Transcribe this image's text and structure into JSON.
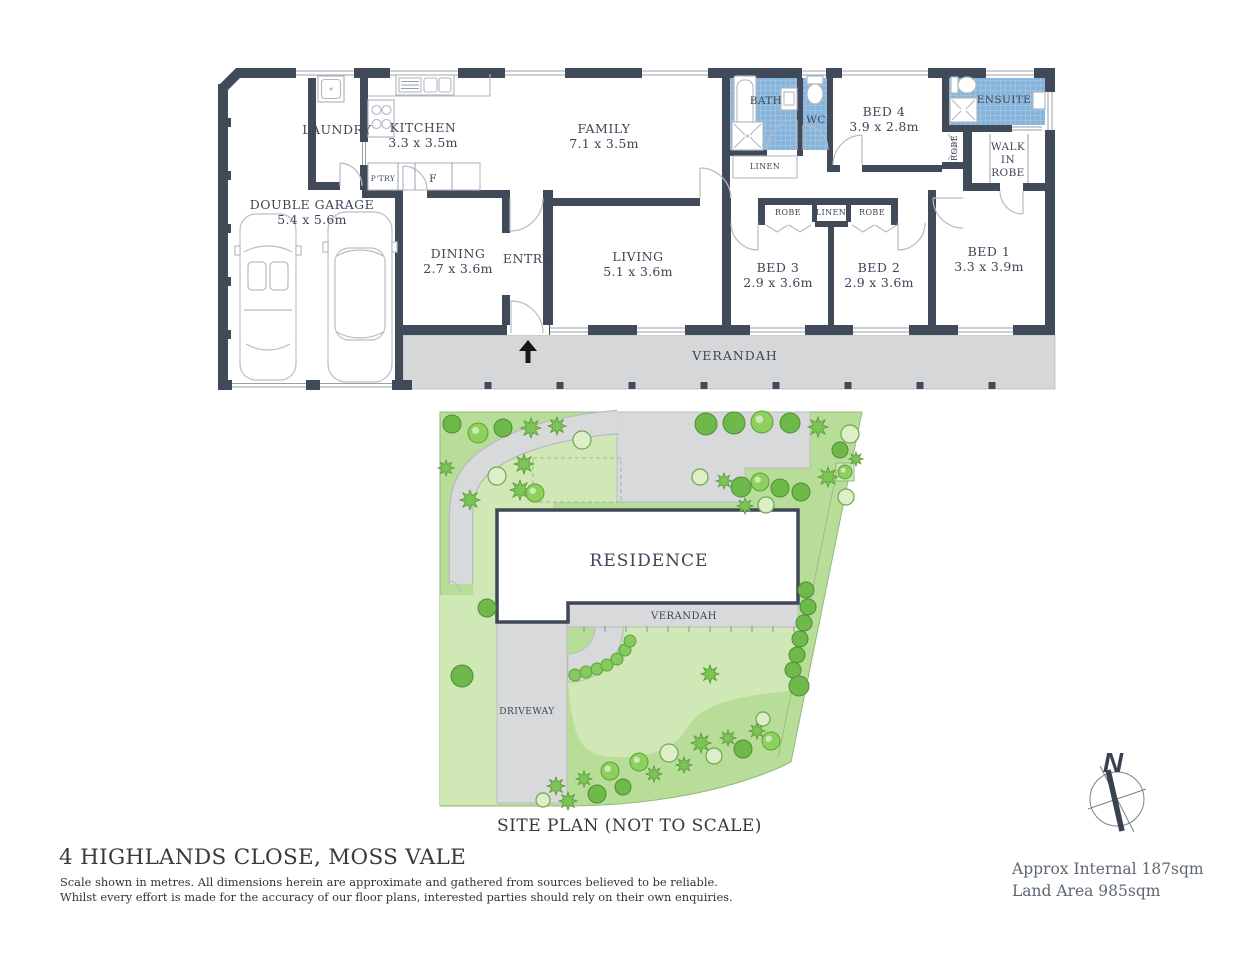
{
  "floorplan": {
    "rooms": [
      {
        "name": "LAUNDRY",
        "dims": ""
      },
      {
        "name": "KITCHEN",
        "dims": "3.3 x 3.5m"
      },
      {
        "name": "FAMILY",
        "dims": "7.1 x 3.5m"
      },
      {
        "name": "BATH",
        "dims": ""
      },
      {
        "name": "WC",
        "dims": ""
      },
      {
        "name": "BED 4",
        "dims": "3.9 x 2.8m"
      },
      {
        "name": "ENSUITE",
        "dims": ""
      },
      {
        "name": "DOUBLE GARAGE",
        "dims": "5.4 x 5.6m"
      },
      {
        "name": "DINING",
        "dims": "2.7 x 3.6m"
      },
      {
        "name": "ENTRY",
        "dims": ""
      },
      {
        "name": "LIVING",
        "dims": "5.1 x 3.6m"
      },
      {
        "name": "BED 3",
        "dims": "2.9 x 3.6m"
      },
      {
        "name": "BED 2",
        "dims": "2.9 x 3.6m"
      },
      {
        "name": "BED 1",
        "dims": "3.3 x 3.9m"
      },
      {
        "name": "VERANDAH",
        "dims": ""
      }
    ],
    "storage": {
      "robe": "ROBE",
      "linen": "LINEN",
      "pantry": "P'TRY",
      "fridge": "F",
      "walk_in_robe": [
        "WALK",
        "IN",
        "ROBE"
      ]
    }
  },
  "site_plan": {
    "residence_label": "RESIDENCE",
    "verandah_label": "VERANDAH",
    "driveway_label": "DRIVEWAY",
    "caption": "SITE PLAN (NOT TO SCALE)"
  },
  "compass": {
    "north_label": "N"
  },
  "footer": {
    "address": "4 HIGHLANDS CLOSE, MOSS VALE",
    "disclaimer_line1": "Scale shown in metres. All dimensions herein are approximate and gathered from sources believed to be  reliable.",
    "disclaimer_line2": "Whilst every effort is made for the accuracy of our floor plans, interested parties should rely on their own enquiries.",
    "area_internal": "Approx Internal 187sqm",
    "area_land": "Land Area 985sqm"
  },
  "colors": {
    "wall": "#414a58",
    "wet_area": "#87b4da",
    "verandah": "#d5d7d9",
    "land_green": "#b7dd98",
    "lawn_green": "#cfe8b6",
    "driveway": "#d8d9da"
  }
}
